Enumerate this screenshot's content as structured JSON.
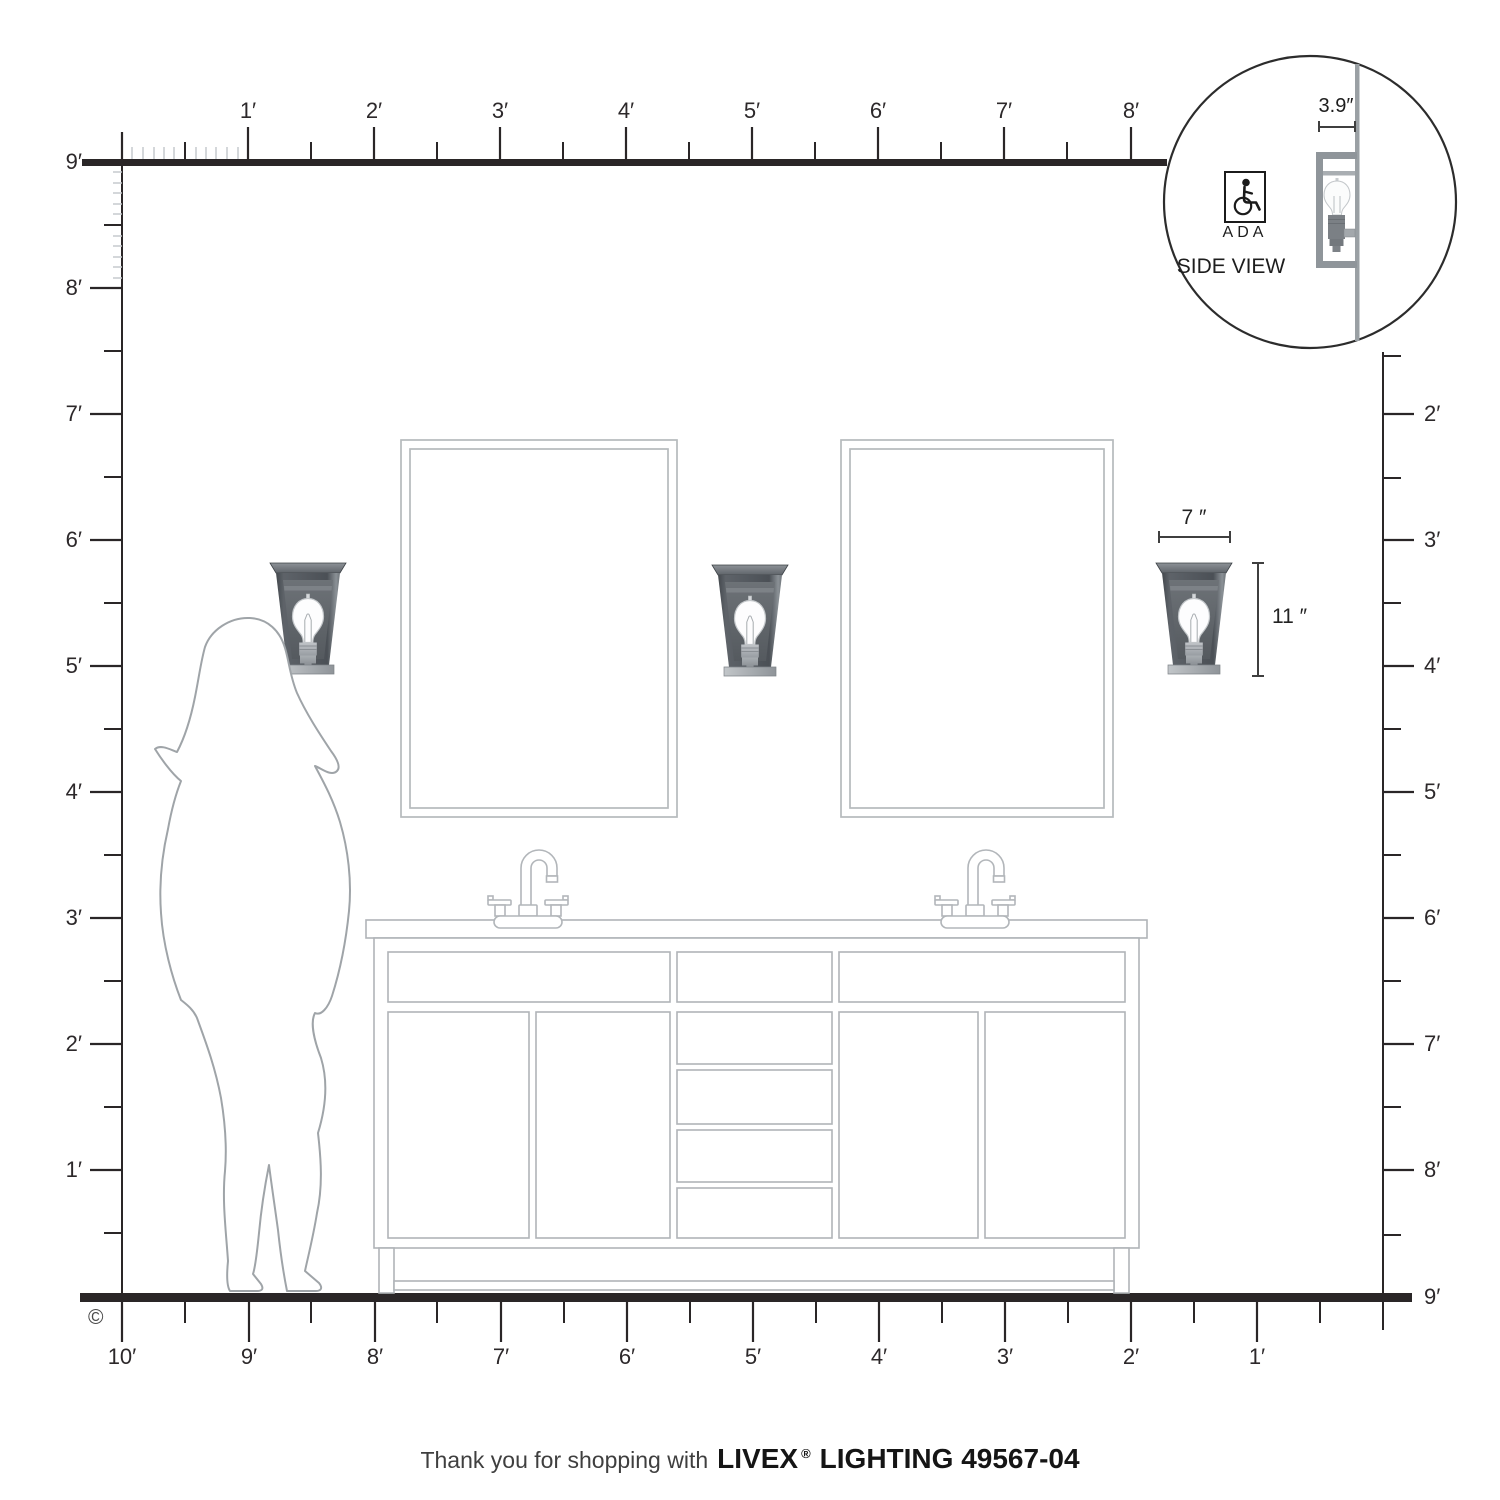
{
  "rulers": {
    "top_labels": [
      "1′",
      "2′",
      "3′",
      "4′",
      "5′",
      "6′",
      "7′",
      "8′"
    ],
    "left_labels": [
      "9′",
      "8′",
      "7′",
      "6′",
      "5′",
      "4′",
      "3′",
      "2′",
      "1′"
    ],
    "right_labels": [
      "2′",
      "3′",
      "4′",
      "5′",
      "6′",
      "7′",
      "8′",
      "9′"
    ],
    "bottom_labels": [
      "10′",
      "9′",
      "8′",
      "7′",
      "6′",
      "5′",
      "4′",
      "3′",
      "2′",
      "1′"
    ]
  },
  "fixture": {
    "width_label": "7 ″",
    "height_label": "11 ″"
  },
  "inset": {
    "depth_label": "3.9″",
    "ada_label": "ADA",
    "view_label": "SIDE VIEW"
  },
  "footer": {
    "message": "Thank you for shopping with",
    "brand": "LIVEX",
    "registered_mark": "®",
    "product_line": "LIGHTING 49567-04"
  },
  "copyright_mark": "©",
  "colors": {
    "ruler_ink": "#2a2627",
    "line_art": "#b2b6ba",
    "silhouette_outline": "#9fa4a8",
    "fixture_dark": "#4b5056",
    "fixture_mid": "#8f959a",
    "wall_gray": "#9aa0a4"
  }
}
